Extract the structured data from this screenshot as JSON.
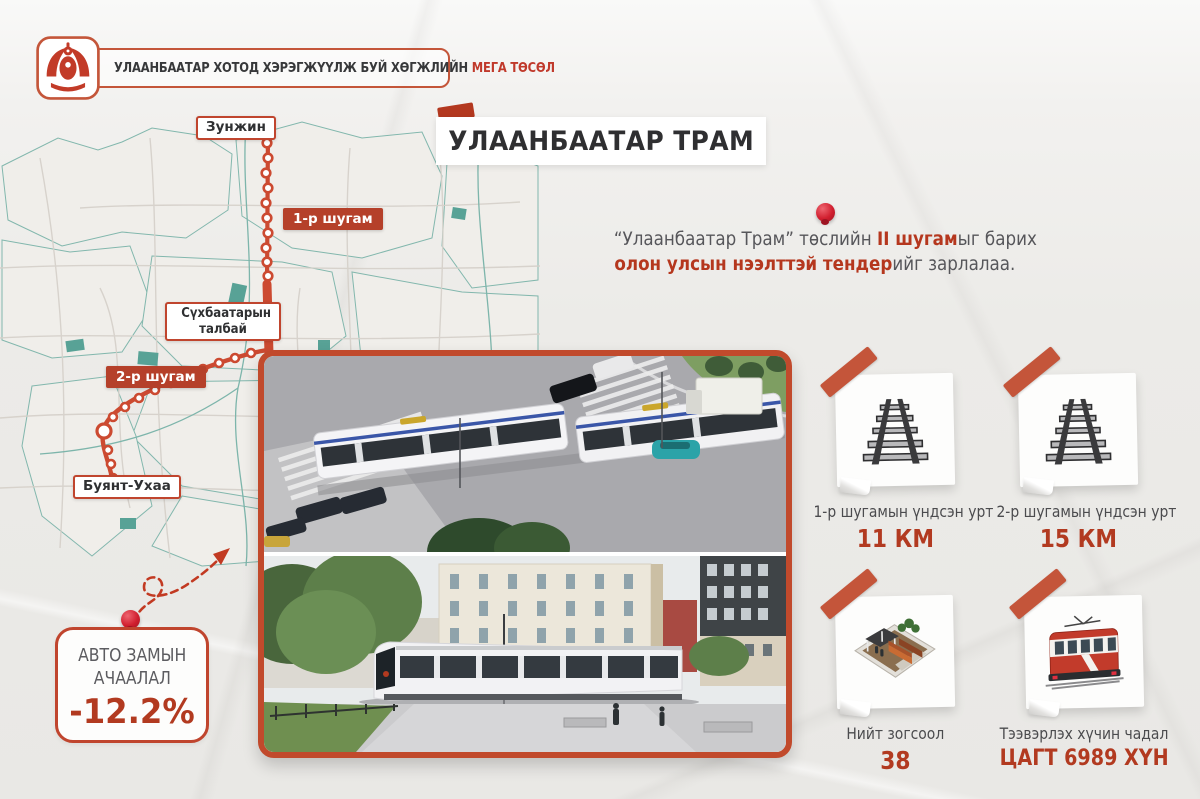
{
  "header": {
    "badge_regular": "УЛААНБААТАР ХОТОД ХЭРЭГЖҮҮЛЖ БУЙ ХӨГЖЛИЙН ",
    "badge_highlight": "МЕГА ТӨСӨЛ"
  },
  "title": "УЛААНБААТАР ТРАМ",
  "announcement": {
    "line1_pre": "“Улаанбаатар Трам” төслийн ",
    "line1_bold": "II шугам",
    "line1_post": "ыг барих",
    "line2_bold": "олон улсын нээлттэй тендер",
    "line2_post": "ийг зарлалаа."
  },
  "map": {
    "labels": {
      "zunjin": "Зунжин",
      "line1": "1-р шугам",
      "sukhbaatar_l1": "Сүхбаатарын",
      "sukhbaatar_l2": "талбай",
      "line2": "2-р шугам",
      "buyant": "Буянт-Ухаа"
    }
  },
  "stats": [
    {
      "icon": "railway-track-icon",
      "label": "1-р шугамын үндсэн урт",
      "value": "11 КМ"
    },
    {
      "icon": "railway-track-icon",
      "label": "2-р шугамын үндсэн урт",
      "value": "15 КМ"
    },
    {
      "icon": "tram-stop-icon",
      "label": "Нийт зогсоол",
      "value": "38"
    },
    {
      "icon": "tram-icon",
      "label": "Тээвэрлэх хүчин чадал",
      "value": "ЦАГТ 6989 ХҮН"
    }
  ],
  "load_box": {
    "line1": "АВТО ЗАМЫН",
    "line2": "АЧААЛАЛ",
    "value": "-12.2%"
  },
  "colors": {
    "accent": "#c14a2c",
    "value_red": "#b23a20",
    "map_teal": "#7db5ab",
    "route_red": "#cc4a31"
  }
}
